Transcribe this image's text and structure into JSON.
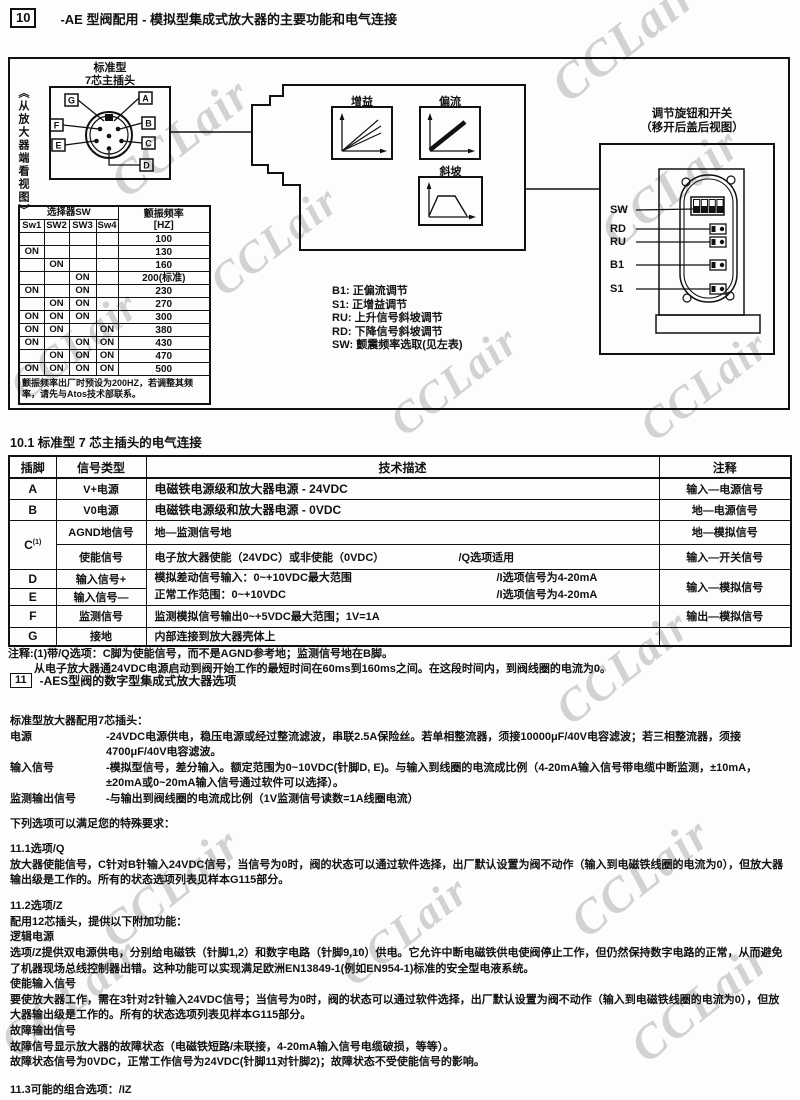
{
  "watermark": "CCLair",
  "header": {
    "num": "10",
    "title": "-AE 型阀配用 - 模拟型集成式放大器的主要功能和电气连接"
  },
  "diagram": {
    "plug_label_1": "标准型",
    "plug_label_2": "7芯主插头",
    "view_label": "《从放大器端看视图》",
    "pins_left": [
      "G",
      "F",
      "E"
    ],
    "pins_right": [
      "A",
      "B",
      "C",
      "D"
    ],
    "graph_gain": "增益",
    "graph_bias": "偏流",
    "graph_ramp": "斜坡",
    "knob_title_1": "调节旋钮和开关",
    "knob_title_2": "（移开后盖后视图）",
    "knob_labels": [
      "SW",
      "RD",
      "RU",
      "B1",
      "S1"
    ],
    "legend": [
      "B1: 正偏流调节",
      "S1: 正增益调节",
      "RU: 上升信号斜坡调节",
      "RD: 下降信号斜坡调节",
      "SW: 颤震频率选取(见左表)"
    ],
    "sw_table": {
      "header_group": "选择器SW",
      "freq_header_1": "颤振频率",
      "freq_header_2": "[HZ]",
      "cols": [
        "Sw1",
        "SW2",
        "SW3",
        "Sw4"
      ],
      "rows": [
        {
          "sw": [
            "",
            "",
            "",
            ""
          ],
          "hz": "100"
        },
        {
          "sw": [
            "ON",
            "",
            "",
            ""
          ],
          "hz": "130"
        },
        {
          "sw": [
            "",
            "ON",
            "",
            ""
          ],
          "hz": "160"
        },
        {
          "sw": [
            "",
            "",
            "ON",
            ""
          ],
          "hz": "200(标准)"
        },
        {
          "sw": [
            "ON",
            "",
            "ON",
            ""
          ],
          "hz": "230"
        },
        {
          "sw": [
            "",
            "ON",
            "ON",
            ""
          ],
          "hz": "270"
        },
        {
          "sw": [
            "ON",
            "ON",
            "ON",
            ""
          ],
          "hz": "300"
        },
        {
          "sw": [
            "ON",
            "ON",
            "",
            "ON"
          ],
          "hz": "380"
        },
        {
          "sw": [
            "ON",
            "",
            "ON",
            "ON"
          ],
          "hz": "430"
        },
        {
          "sw": [
            "",
            "ON",
            "ON",
            "ON"
          ],
          "hz": "470"
        },
        {
          "sw": [
            "ON",
            "ON",
            "ON",
            "ON"
          ],
          "hz": "500"
        }
      ],
      "note": "颤振频率出厂时预设为200HZ，若调整其频率，请先与Atos技术部联系。"
    }
  },
  "section10_1": {
    "title": "10.1  标准型 7 芯主插头的电气连接"
  },
  "main_table": {
    "headers": [
      "插脚",
      "信号类型",
      "技术描述",
      "注释"
    ],
    "rows": {
      "a": {
        "pin": "A",
        "type": "V+电源",
        "desc": "电磁铁电源级和放大器电源 - 24VDC",
        "note": "输入—电源信号"
      },
      "b": {
        "pin": "B",
        "type": "V0电源",
        "desc": "电磁铁电源级和放大器电源 - 0VDC",
        "note": "地—电源信号"
      },
      "c1": {
        "pin": "C",
        "sup": "(1)",
        "type": "AGND地信号",
        "desc": "地—监测信号地",
        "note": "地—模拟信号"
      },
      "c2": {
        "type": "使能信号",
        "desc": "电子放大器使能（24VDC）或非使能（0VDC）",
        "desc2": "/Q选项适用",
        "note": "输入—开关信号"
      },
      "d": {
        "pin": "D",
        "type": "输入信号+",
        "desc": "模拟差动信号输入：0~+10VDC最大范围",
        "desc2": "/I选项信号为4-20mA",
        "note": "输入—模拟信号"
      },
      "e": {
        "pin": "E",
        "type": "输入信号—",
        "desc": "正常工作范围：0~+10VDC",
        "desc2": "/I选项信号为4-20mA"
      },
      "f": {
        "pin": "F",
        "type": "监测信号",
        "desc": "监测模拟信号输出0~+5VDC最大范围；1V=1A",
        "note": "输出—模拟信号"
      },
      "g": {
        "pin": "G",
        "type": "接地",
        "desc": "内部连接到放大器壳体上",
        "note": ""
      }
    },
    "note_line1": "注释:(1)带/Q选项：C脚为使能信号，而不是AGND参考地；监测信号地在B脚。",
    "note_line2": "从电子放大器通24VDC电源启动到阀开始工作的最短时间在60ms到160ms之间。在这段时间内，到阀线圈的电流为0。"
  },
  "section11": {
    "num": "11",
    "title": "-AES型阀的数字型集成式放大器选项",
    "intro": "标准型放大器配用7芯插头：",
    "specs": [
      {
        "label": "电源",
        "text": "-24VDC电源供电，稳压电源或经过整流滤波，串联2.5A保险丝。若单相整流器，须接10000μF/40V电容滤波；若三相整流器，须接4700μF/40V电容滤波。"
      },
      {
        "label": "输入信号",
        "text": "-模拟型信号，差分输入。额定范围为0~10VDC(针脚D, E)。与输入到线圈的电流成比例（4-20mA输入信号带电缆中断监测，±10mA，±20mA或0~20mA输入信号通过软件可以选择）。"
      },
      {
        "label": "监测输出信号",
        "text": "-与输出到阀线圈的电流成比例（1V监测信号读数=1A线圈电流）"
      }
    ],
    "options_intro": "下列选项可以满足您的特殊要求：",
    "opt_q": {
      "heading": "11.1选项/Q",
      "body": "放大器使能信号，C针对B针输入24VDC信号，当信号为0时，阀的状态可以通过软件选择，出厂默认设置为阀不动作（输入到电磁铁线圈的电流为0），但放大器输出级是工作的。所有的状态选项列表见样本G115部分。"
    },
    "opt_z": {
      "heading": "11.2选项/Z",
      "intro": "配用12芯插头，提供以下附加功能：",
      "sub1_title": "逻辑电源",
      "sub1_body": "选项/Z提供双电源供电，分别给电磁铁（针脚1,2）和数字电路（针脚9,10）供电。它允许中断电磁铁供电使阀停止工作，但仍然保持数字电路的正常，从而避免了机器现场总线控制器出错。这种功能可以实现满足欧洲EN13849-1(例如EN954-1)标准的安全型电液系统。",
      "sub2_title": "使能输入信号",
      "sub2_body": "要使放大器工作，需在3针对2针输入24VDC信号；当信号为0时，阀的状态可以通过软件选择，出厂默认设置为阀不动作（输入到电磁铁线圈的电流为0），但放大器输出级是工作的。所有的状态选项列表见样本G115部分。",
      "sub3_title": "故障输出信号",
      "sub3_body1": "故障信号显示放大器的故障状态（电磁铁短路/未联接，4-20mA输入信号电缆破损，等等）。",
      "sub3_body2": "故障状态信号为0VDC，正常工作信号为24VDC(针脚11对针脚2)；故障状态不受使能信号的影响。"
    },
    "combos": "11.3可能的组合选项：/IZ"
  }
}
